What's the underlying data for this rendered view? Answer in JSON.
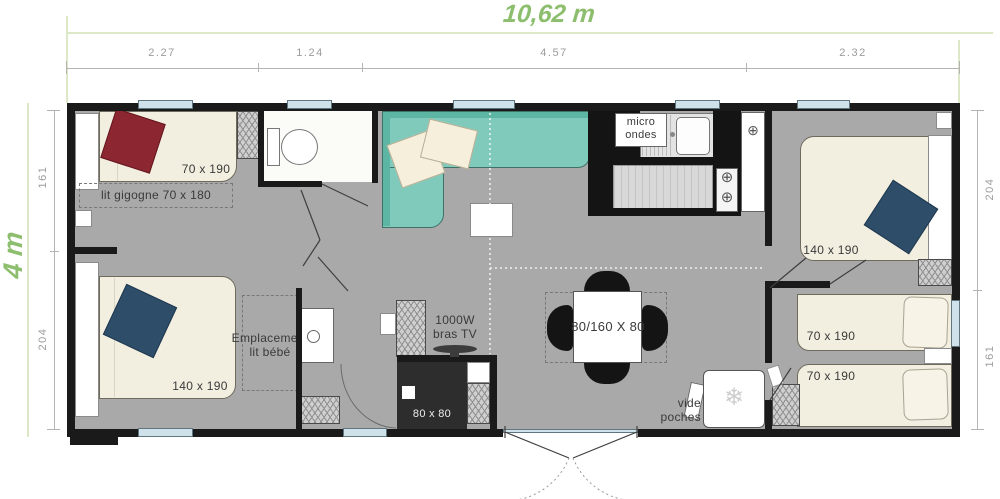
{
  "plan_title": {
    "width_label": "10,62 m",
    "height_label": "4 m"
  },
  "dimensions": {
    "top_segments": [
      "2.27",
      "1.24",
      "4.57",
      "2.32"
    ],
    "left_segments": [
      "161",
      "204"
    ],
    "right_segments": [
      "204",
      "161"
    ]
  },
  "rooms": {
    "bedroom_top_left": {
      "bed": "70 x 190",
      "pullout": "lit gigogne 70 x 180"
    },
    "bedroom_bottom_left": {
      "bed": "140 x 190",
      "baby": "Emplacement lit bébé"
    },
    "bedroom_right": {
      "bed": "140 x 190"
    },
    "bedroom_singles": {
      "bed_top": "70 x 190",
      "bed_bottom": "70 x 190"
    },
    "kitchen": {
      "microwave": "micro ondes"
    },
    "living": {
      "tv": "1000W bras TV",
      "table": "80/160 X 80"
    },
    "bathroom": {
      "shower": "80 x 80"
    },
    "entry": {
      "storage": "vide poches"
    }
  },
  "icons": {
    "freezer": "❄",
    "burner_1": "⊕",
    "burner_2": "⊕",
    "heater": "⊕"
  },
  "colors": {
    "accent_green": "#8cbe6e",
    "wall": "#1a1a1a",
    "floor": "#a9a9a9",
    "sofa_teal": "#7fcabb",
    "pillow_red": "#8c2731",
    "pillow_navy": "#2e4d68",
    "bed_cream": "#f2efe0",
    "window_blue": "#cfe2ea",
    "shower_dark": "#2d2d2d"
  }
}
